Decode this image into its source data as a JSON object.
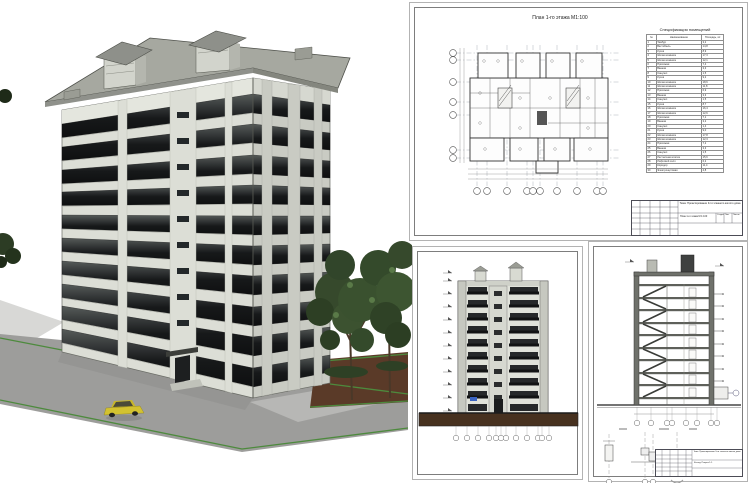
{
  "colors": {
    "facade_light": "#dcded6",
    "facade_side": "#c9cbc3",
    "roof": "#a6a8a0",
    "window_glass": "#17191a",
    "pavement": "#9d9d9b",
    "curb_green": "#4d8a3d",
    "dirt_brown": "#5a3a28",
    "tree_green": "#3a512f",
    "car_yellow": "#d3c230",
    "drawing_line": "#444444",
    "detail_blue": "#2b4fc0"
  },
  "sheet_plan": {
    "title": "План 1-го этажа М1:100",
    "spec": {
      "title": "Спецификация помещений",
      "columns": [
        "№",
        "Наименование",
        "Площадь, м²"
      ],
      "rows": [
        {
          "n": "1",
          "name": "Тамбур",
          "area": "3,2"
        },
        {
          "n": "2",
          "name": "Вестибюль",
          "area": "14,8"
        },
        {
          "n": "3",
          "name": "Кухня",
          "area": "8,9"
        },
        {
          "n": "4",
          "name": "Жилая комната",
          "area": "17,3"
        },
        {
          "n": "5",
          "name": "Жилая комната",
          "area": "12,1"
        },
        {
          "n": "6",
          "name": "Прихожая",
          "area": "7,4"
        },
        {
          "n": "7",
          "name": "Ванная",
          "area": "3,3"
        },
        {
          "n": "8",
          "name": "Санузел",
          "area": "1,5"
        },
        {
          "n": "9",
          "name": "Кухня",
          "area": "9,2"
        },
        {
          "n": "10",
          "name": "Жилая комната",
          "area": "18,6"
        },
        {
          "n": "11",
          "name": "Жилая комната",
          "area": "11,8"
        },
        {
          "n": "12",
          "name": "Прихожая",
          "area": "6,9"
        },
        {
          "n": "13",
          "name": "Ванная",
          "area": "3,3"
        },
        {
          "n": "14",
          "name": "Санузел",
          "area": "1,5"
        },
        {
          "n": "15",
          "name": "Кухня",
          "area": "8,7"
        },
        {
          "n": "16",
          "name": "Жилая комната",
          "area": "16,4"
        },
        {
          "n": "17",
          "name": "Жилая комната",
          "area": "12,6"
        },
        {
          "n": "18",
          "name": "Прихожая",
          "area": "7,1"
        },
        {
          "n": "19",
          "name": "Ванная",
          "area": "3,2"
        },
        {
          "n": "20",
          "name": "Санузел",
          "area": "1,4"
        },
        {
          "n": "21",
          "name": "Кухня",
          "area": "9,0"
        },
        {
          "n": "22",
          "name": "Жилая комната",
          "area": "17,8"
        },
        {
          "n": "23",
          "name": "Жилая комната",
          "area": "12,3"
        },
        {
          "n": "24",
          "name": "Прихожая",
          "area": "7,2"
        },
        {
          "n": "25",
          "name": "Ванная",
          "area": "3,3"
        },
        {
          "n": "26",
          "name": "Санузел",
          "area": "1,5"
        },
        {
          "n": "27",
          "name": "Лестничная клетка",
          "area": "15,6"
        },
        {
          "n": "28",
          "name": "Лифтовой холл",
          "area": "6,2"
        },
        {
          "n": "29",
          "name": "Коридор",
          "area": "11,4"
        },
        {
          "n": "30",
          "name": "Электрощитовая",
          "area": "4,8"
        }
      ]
    },
    "title_block": {
      "theme": "Тема: Проектирование 9-ти этажного жилого дома",
      "doc": "План 1-го этажа М 1:100",
      "stage": "Стадия",
      "sheet": "Лист",
      "sheets": "Листов"
    }
  },
  "sheet_section": {
    "title_block": {
      "theme": "Тема: Проектирование 9-ти этажного жилого дома",
      "doc": "Фасад. Разрез 1-1"
    }
  }
}
